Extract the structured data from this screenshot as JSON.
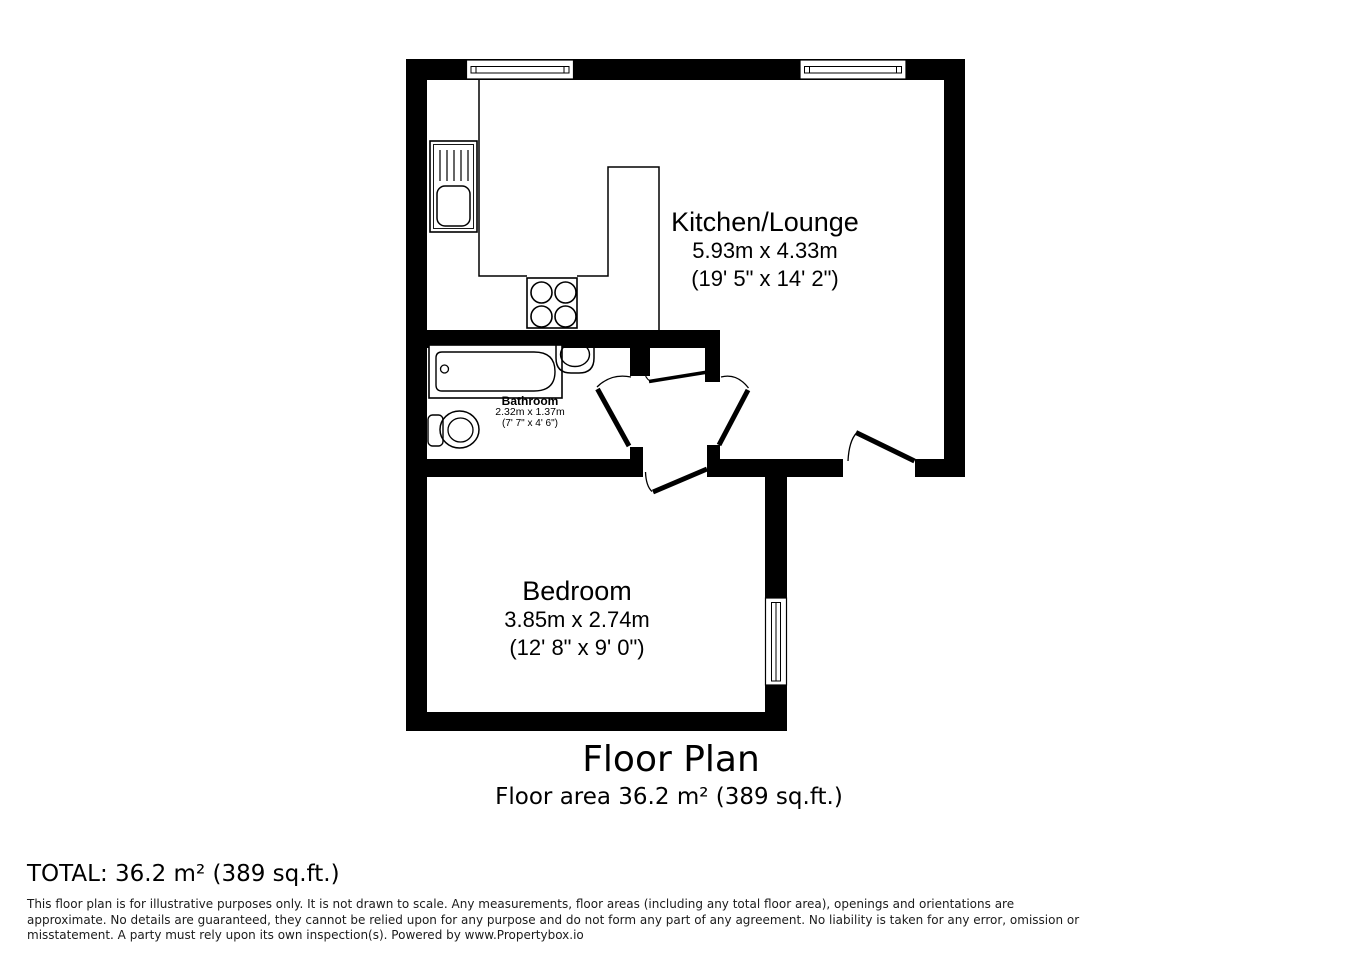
{
  "plan": {
    "title": "Floor Plan",
    "floor_area": "Floor area 36.2 m² (389 sq.ft.)",
    "rooms": [
      {
        "name": "Kitchen/Lounge",
        "dim_metric": "5.93m x 4.33m",
        "dim_imperial": "(19' 5\" x 14' 2\")"
      },
      {
        "name": "Bathroom",
        "dim_metric": "2.32m x 1.37m",
        "dim_imperial": "(7' 7\" x 4' 6\")"
      },
      {
        "name": "Bedroom",
        "dim_metric": "3.85m x 2.74m",
        "dim_imperial": "(12' 8\" x 9' 0\")"
      }
    ],
    "fixtures": [
      "kitchen-sink",
      "hob",
      "bathtub",
      "wash-basin",
      "toilet"
    ],
    "colors": {
      "wall": "#000000",
      "floor": "#ffffff"
    }
  },
  "footer": {
    "total": "TOTAL: 36.2 m² (389 sq.ft.)",
    "disclaimer_lines": [
      "This floor plan is for illustrative purposes only. It is not drawn to scale. Any measurements, floor areas (including any total floor area), openings and orientations are",
      "approximate. No details are guaranteed, they cannot be relied upon for any purpose and do not form any part of any agreement. No liability is taken for any error, omission or",
      "misstatement. A party must rely upon its own inspection(s). Powered by www.Propertybox.io"
    ]
  }
}
